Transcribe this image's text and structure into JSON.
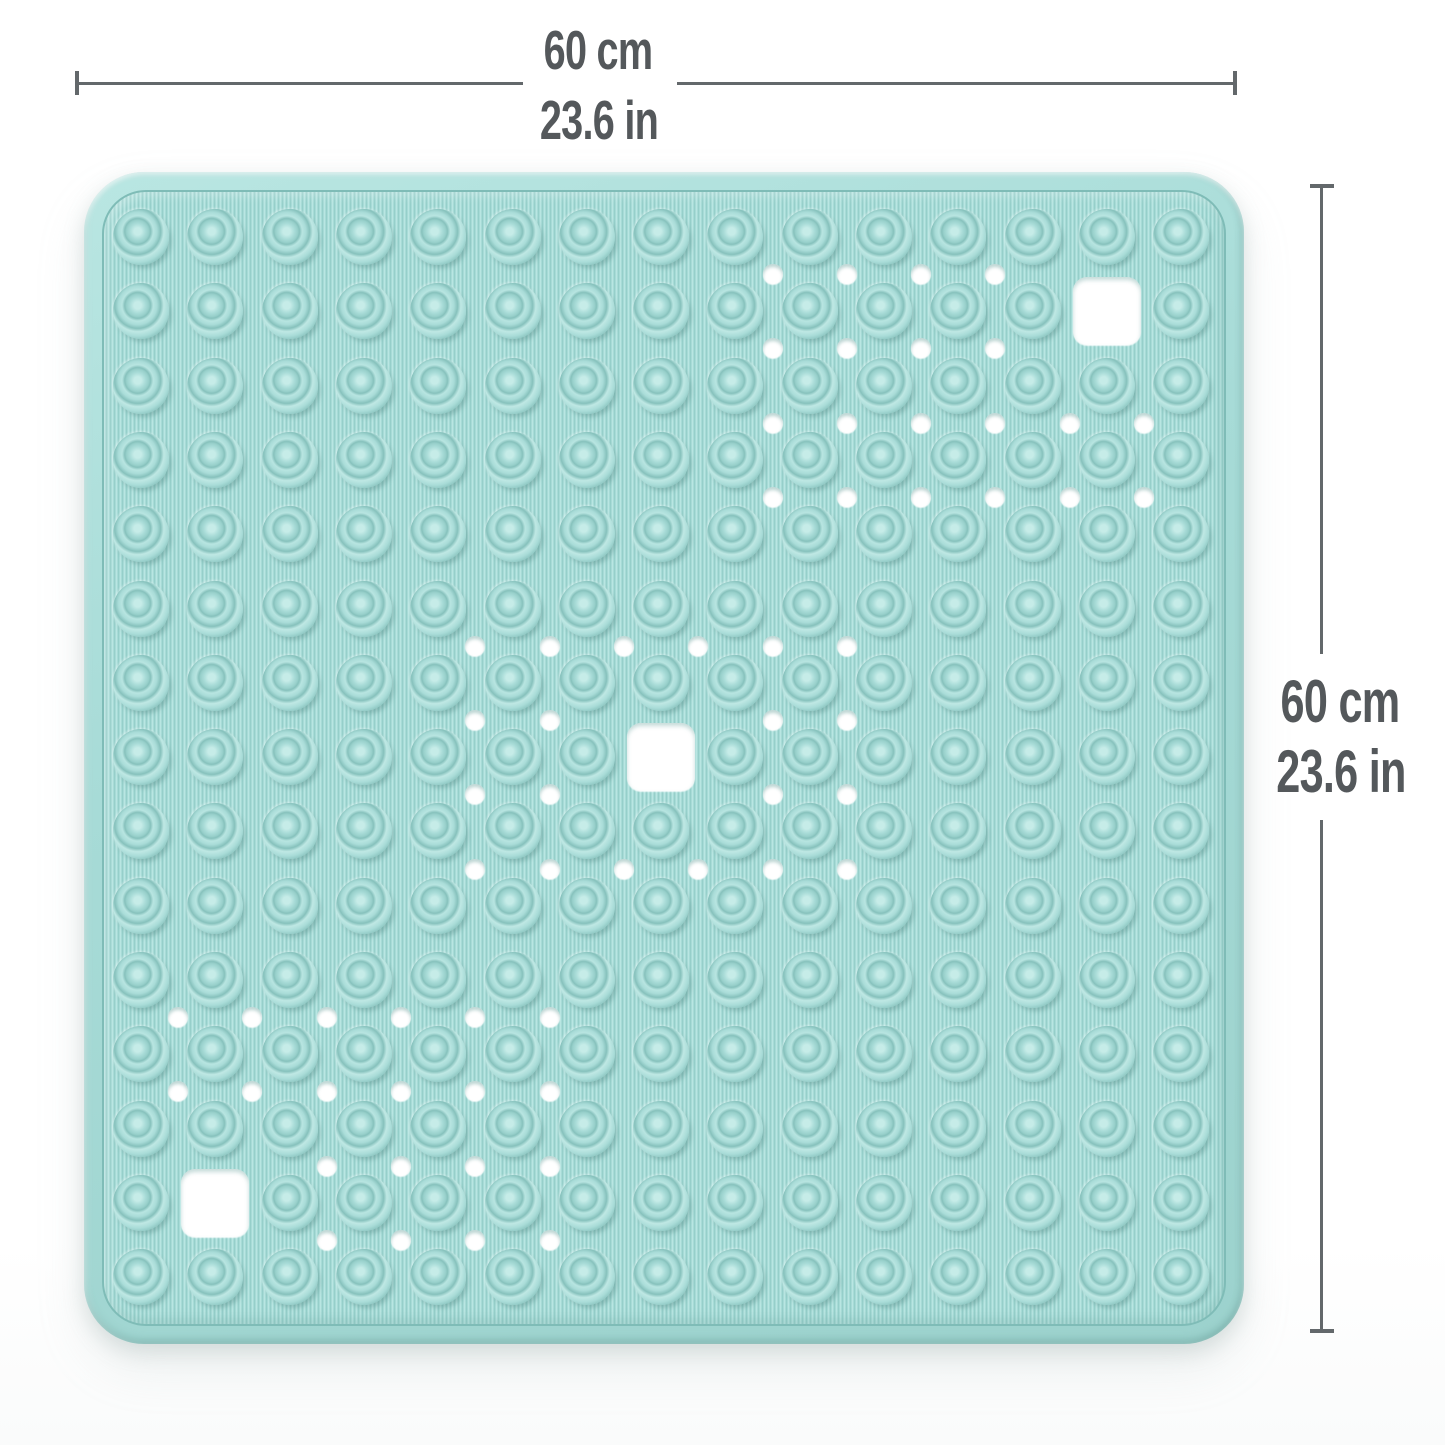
{
  "product": {
    "name": "square non-slip bath shower mat",
    "material_look": "textured rubber with suction cups and drainage holes"
  },
  "dimensions": {
    "width": {
      "metric": "60 cm",
      "imperial": "23.6 in"
    },
    "height": {
      "metric": "60 cm",
      "imperial": "23.6 in"
    }
  },
  "colors": {
    "mat-base": "#a7dbd7",
    "mat-rib-light": "#b9e6e2",
    "mat-rib-dark": "#96cfca",
    "mat-groove": "#7fbcb7",
    "cup-light": "#c6ece8",
    "cup-mid": "#a9dcd8",
    "cup-dark": "#86c1bc",
    "hole": "#ffffff",
    "dim-line": "#63686b",
    "dim-text": "#54585b"
  },
  "mat": {
    "pattern": {
      "grid": {
        "cols": 15,
        "rows": 15,
        "origin_x": 141,
        "origin_y": 237,
        "pitch": 74.3,
        "cup_diameter": 56
      },
      "drain_hole_diameter": 20,
      "square_hole_size": 68,
      "clusters": [
        {
          "i0": 8,
          "i1": 13,
          "j0": 0,
          "j1": 3,
          "square_col": 13,
          "square_row": 1
        },
        {
          "i0": 4,
          "i1": 9,
          "j0": 5,
          "j1": 8,
          "square_col": 7,
          "square_row": 7
        },
        {
          "i0": 0,
          "i1": 5,
          "j0": 10,
          "j1": 13,
          "square_col": 1,
          "square_row": 13
        }
      ]
    }
  }
}
